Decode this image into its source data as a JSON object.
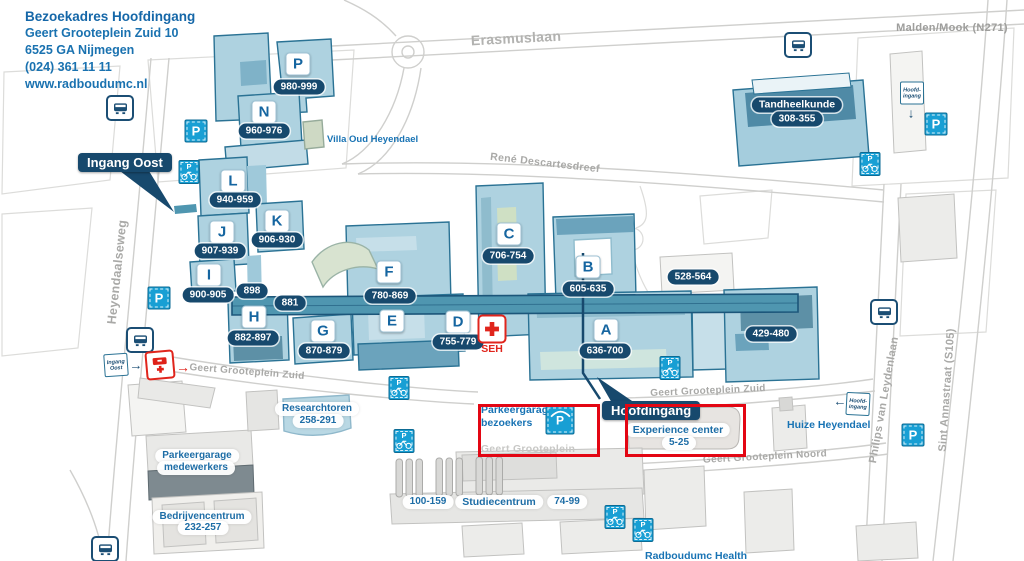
{
  "map": {
    "address": {
      "title": "Bezoekadres Hoofdingang",
      "street": "Geert Grooteplein Zuid 10",
      "city": "6525 GA Nijmegen",
      "phone": "(024) 361 11 11",
      "website": "www.radboudumc.nl"
    },
    "region": "Malden/Mook (N271)",
    "streets": {
      "erasmuslaan": "Erasmuslaan",
      "rene_descartesdreef": "René Descartesdreef",
      "heyendaalseweg": "Heyendaalseweg",
      "geert_grooteplein_zuid": "Geert Grooteplein Zuid",
      "geert_grooteplein": "Geert Grooteplein",
      "geert_grooteplein_noord": "Geert Grooteplein Noord",
      "philips_van_leydenlaan": "Philips van Leydenlaan",
      "sint_annastraat": "Sint Annastraat (S105)"
    },
    "entrances": {
      "ingang_oost": "Ingang Oost",
      "hoofdingang": "Hoofdingang"
    },
    "signs": {
      "hoofdingang_top": {
        "l1": "Hoofd-",
        "l2": "ingang"
      },
      "hoofdingang_right": {
        "l1": "Hoofd-",
        "l2": "ingang"
      },
      "ingang_oost": {
        "l1": "Ingang",
        "l2": "Oost"
      },
      "arrows": {
        "down": "↓",
        "left": "←",
        "right": "→"
      }
    },
    "buildings": [
      {
        "letter": "P",
        "range": "980-999"
      },
      {
        "letter": "N",
        "range": "960-976"
      },
      {
        "letter": "L",
        "range": "940-959"
      },
      {
        "letter": "K",
        "range": "906-930"
      },
      {
        "letter": "J",
        "range": "907-939"
      },
      {
        "letter": "I",
        "range": "900-905"
      },
      {
        "letter": "H",
        "range": "882-897"
      },
      {
        "letter": "G",
        "range": "870-879"
      },
      {
        "letter": "F",
        "range": "780-869"
      },
      {
        "letter": "E",
        "range": ""
      },
      {
        "letter": "D",
        "range": "755-779"
      },
      {
        "letter": "C",
        "range": "706-754"
      },
      {
        "letter": "B",
        "range": "605-635"
      },
      {
        "letter": "A",
        "range": "636-700"
      }
    ],
    "ranges": {
      "r528": "528-564",
      "r429": "429-480",
      "r898": "898",
      "r881": "881",
      "r100": "100-159",
      "r74": "74-99"
    },
    "places": {
      "tandheelkunde": {
        "name": "Tandheelkunde",
        "range": "308-355"
      },
      "villa_oud_heyendael": "Villa Oud Heyendael",
      "researchtoren": {
        "name": "Researchtoren",
        "range": "258-291"
      },
      "parkeergarage_medewerkers": {
        "line1": "Parkeergarage",
        "line2": "medewerkers"
      },
      "bedrijvencentrum": {
        "name": "Bedrijvencentrum",
        "range": "232-257"
      },
      "studiecentrum": "Studiecentrum",
      "parkeergarage_bezoekers": {
        "line1": "Parkeergarage",
        "line2": "bezoekers"
      },
      "experience_center": {
        "name": "Experience center",
        "range": "5-25"
      },
      "huize_heyendael": "Huize Heyendael",
      "radboudumc_health": "Radboudumc Health",
      "seh": "SEH"
    },
    "icons": {
      "parking": "P"
    },
    "colors": {
      "navy": "#17496d",
      "accent_blue": "#189fd4",
      "building_blue": "#aed2e0",
      "building_border": "#2a7294",
      "text_blue": "#1873b4",
      "red": "#e30613",
      "street_gray": "#a9a9a7"
    }
  }
}
